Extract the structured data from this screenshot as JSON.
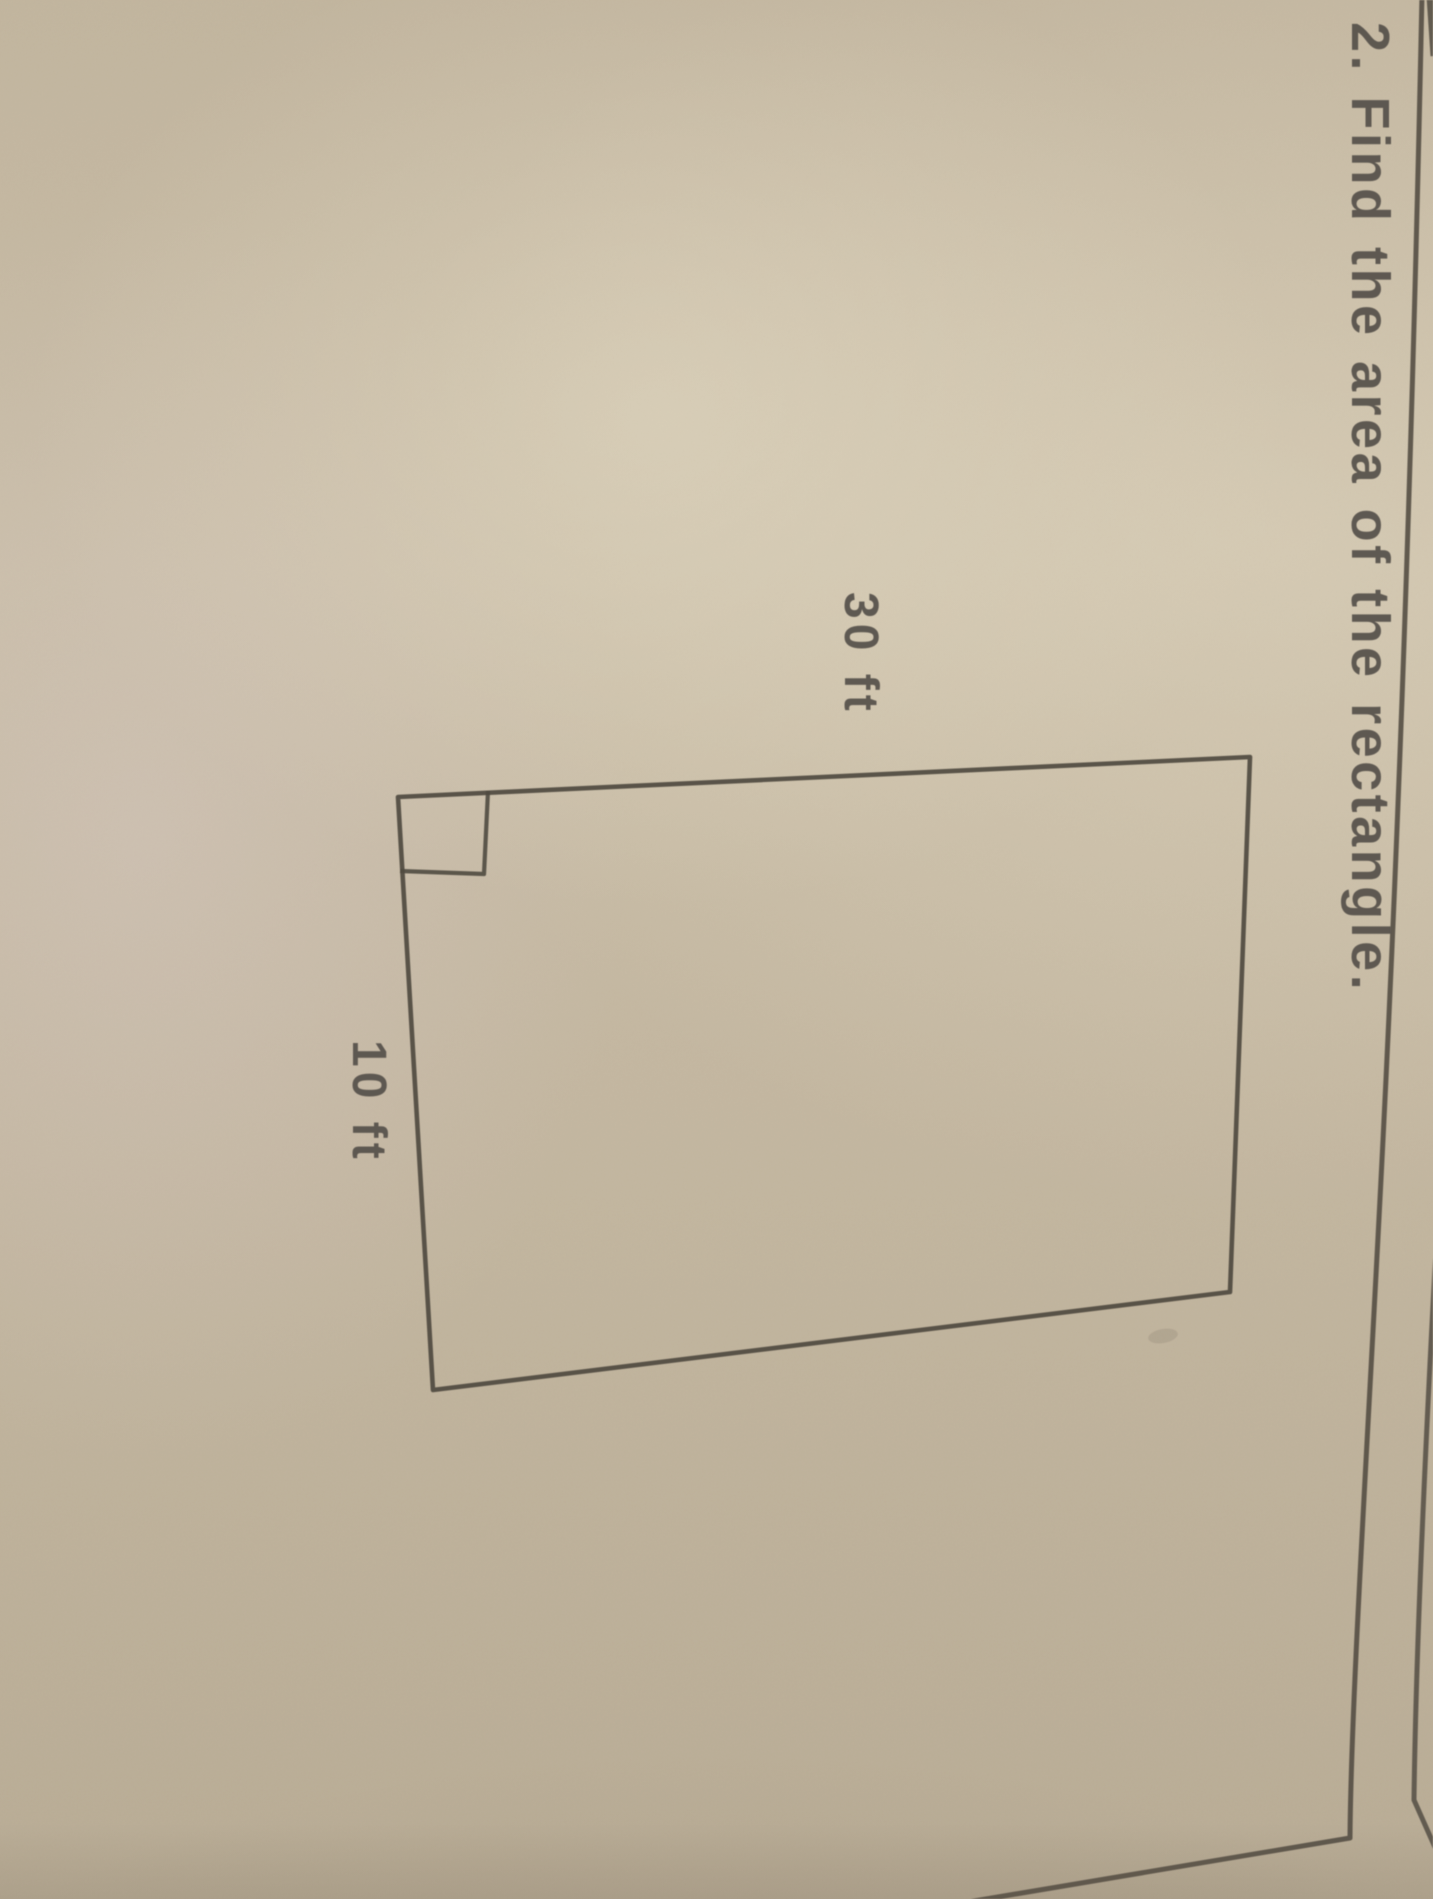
{
  "heading": {
    "number": "2.",
    "prompt": "Find the area of the rectangle.",
    "text": "2. Find the area of the rectangle."
  },
  "figure": {
    "shape": "rectangle",
    "height_label": "30 ft",
    "width_label": "10 ft",
    "right_angle_mark": true
  },
  "orientation": {
    "content_rotation_deg": 90
  },
  "colors": {
    "paper": "#c6baa4",
    "ink": "#55504a",
    "pencil_line": "#544e44"
  }
}
